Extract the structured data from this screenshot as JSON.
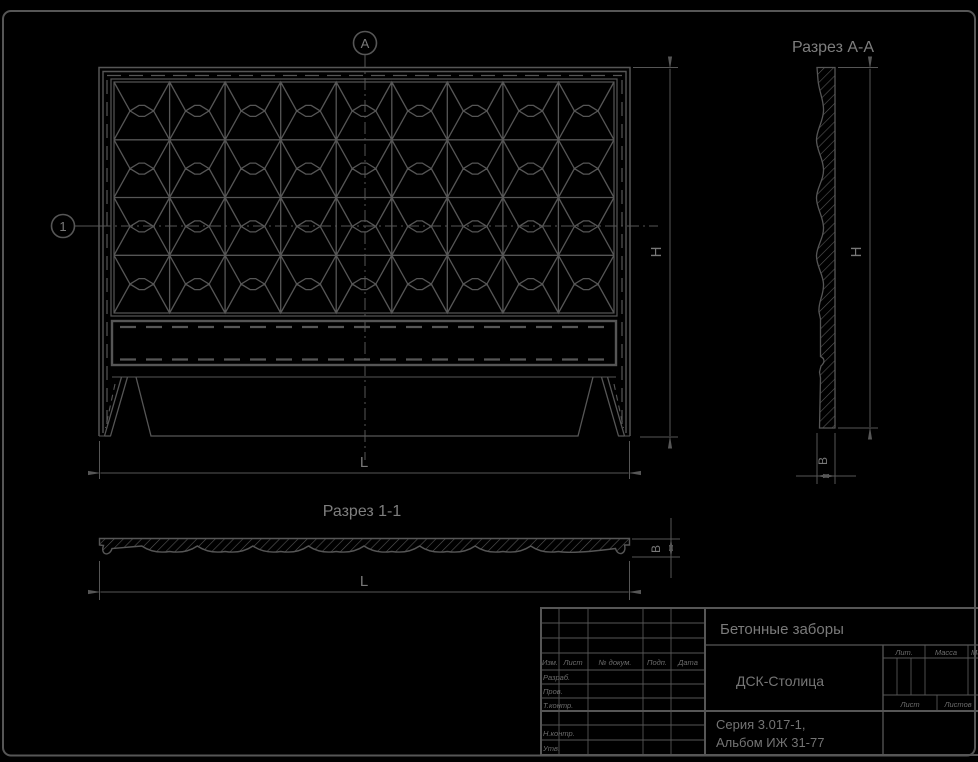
{
  "colors": {
    "background": "#000000",
    "line": "#565656",
    "text": "#7a7a7a"
  },
  "drawing": {
    "front_view": {
      "section_marker_top": "А",
      "row_marker_left": "1",
      "height_label": "H",
      "length_label": "L"
    },
    "section_aa": {
      "title": "Разрез А-А",
      "height_label": "H",
      "thickness_label": "В"
    },
    "section_11": {
      "title": "Разрез 1-1",
      "length_label": "L",
      "thickness_label": "В"
    }
  },
  "title_block": {
    "product_name": "Бетонные заборы",
    "organization": "ДСК-Столица",
    "series_line1": "Серия 3.017-1,",
    "series_line2": "Альбом ИЖ 31-77",
    "header_columns": {
      "izm": "Изм.",
      "list": "Лист",
      "doc_num": "№ докум.",
      "podp": "Подп.",
      "data": "Дата"
    },
    "row_labels": {
      "razrab": "Разраб.",
      "prov": "Пров.",
      "t_kontr": "Т.контр.",
      "n_kontr": "Н.контр.",
      "utv": "Утв."
    },
    "right_labels": {
      "lit": "Лит.",
      "massa": "Масса",
      "masshtab": "Масштаб",
      "list": "Лист",
      "listov": "Листов"
    }
  }
}
